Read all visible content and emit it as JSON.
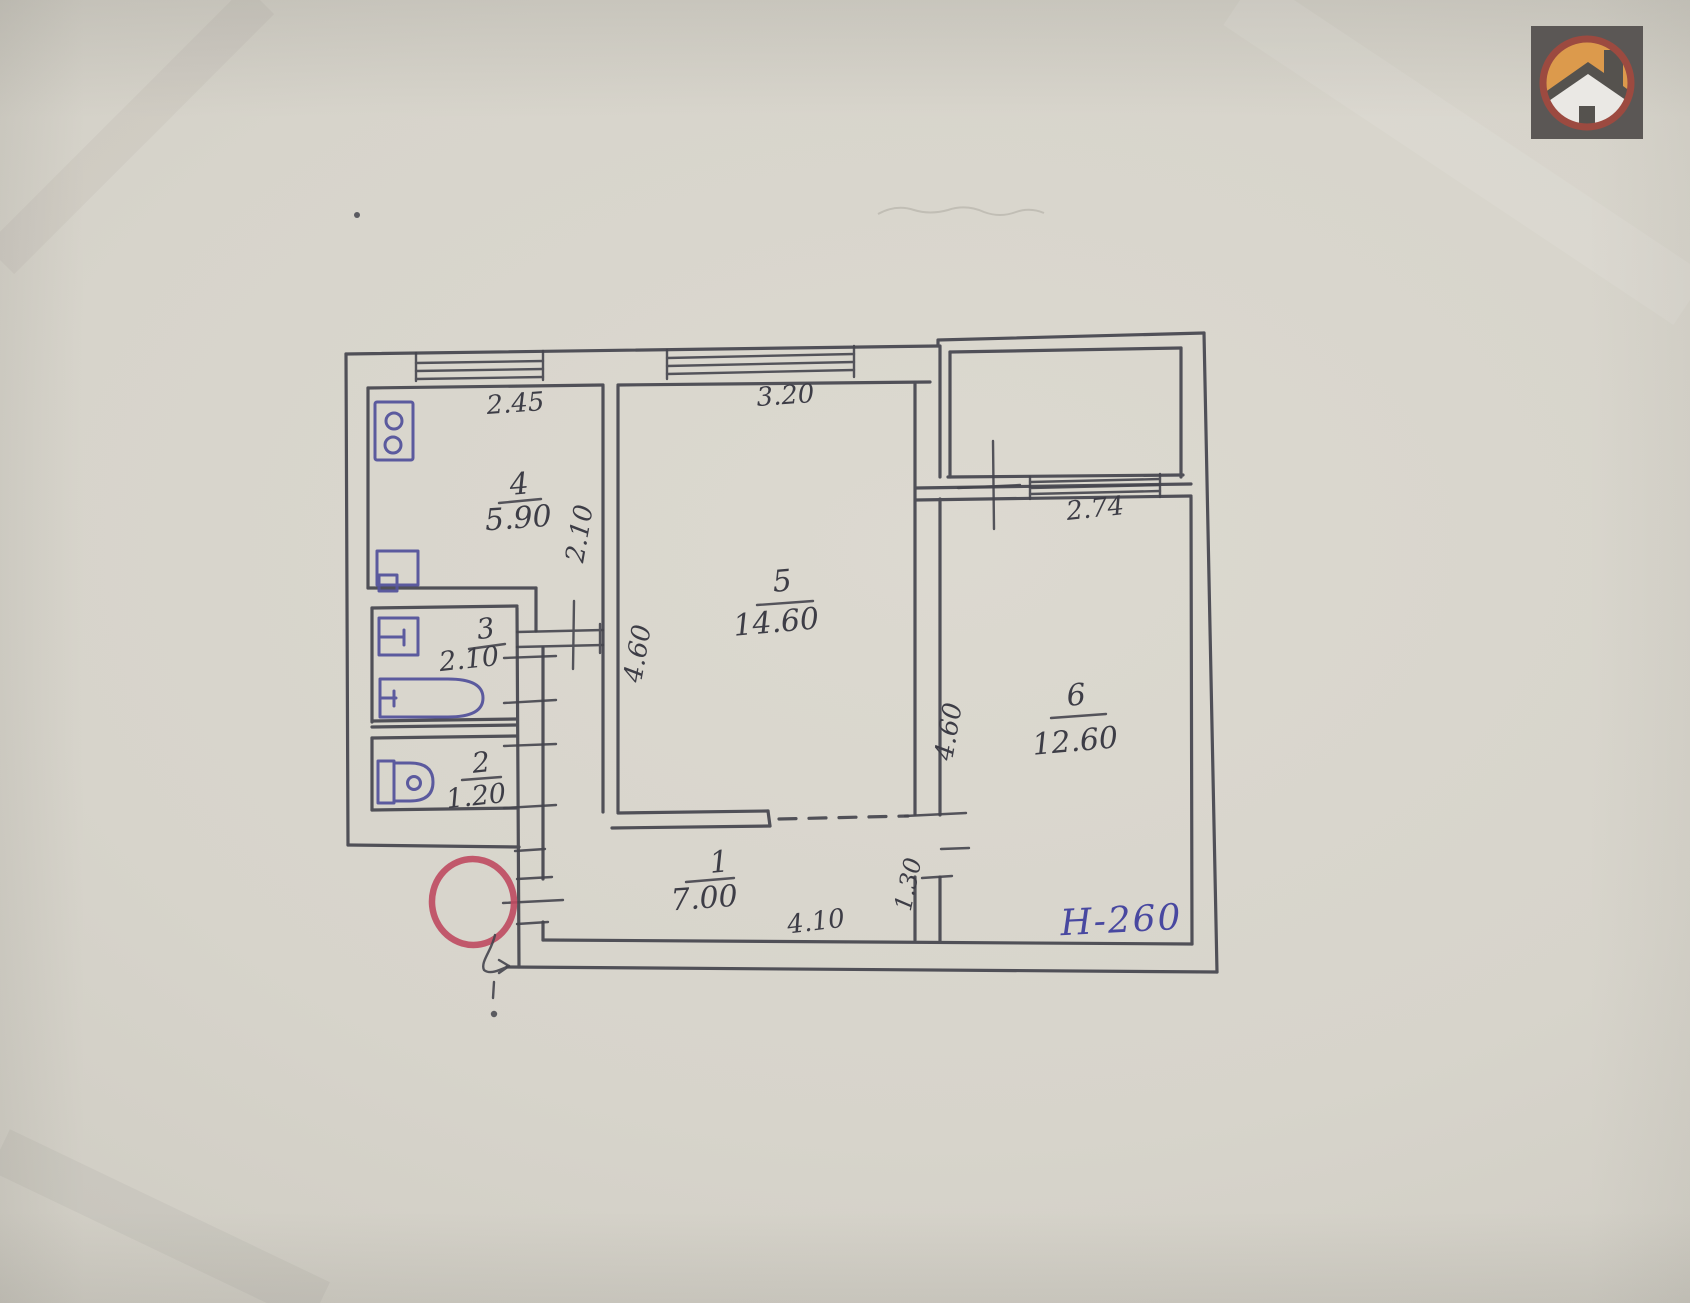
{
  "document": {
    "type": "scanned apartment floor plan",
    "paper_color": "#d7d4cb",
    "pencil_ink_color": "#45454e",
    "fixture_ink_color": "#55549c",
    "entrance_marker_color": "#bf4a60"
  },
  "logo": {
    "name": "house-logo",
    "square_color": "#5b5755",
    "ring_color": "#9c4a40",
    "sky_color": "#dc9a4c",
    "house_color": "#eae8e4",
    "roof_color": "#55524e"
  },
  "rooms": [
    {
      "number": "1",
      "area": "7.00"
    },
    {
      "number": "2",
      "area": "1.20"
    },
    {
      "number": "3",
      "area": "2.10"
    },
    {
      "number": "4",
      "area": "5.90"
    },
    {
      "number": "5",
      "area": "14.60"
    },
    {
      "number": "6",
      "area": "12.60"
    }
  ],
  "dimensions": {
    "kitchen_window": "2.45",
    "living_room_window": "3.20",
    "bedroom_window": "2.74",
    "hallway_length": "4.10",
    "corridor_depth": "2.10",
    "living_room_depth": "4.60",
    "bedroom_depth": "4.60",
    "hallway_nook": "1.30"
  },
  "annotations": {
    "ceiling_height": "H-260"
  },
  "icons": [
    "house-logo",
    "stove-icon",
    "kitchen-sink-icon",
    "washbasin-icon",
    "bathtub-icon",
    "toilet-icon",
    "entrance-circle-marker",
    "entrance-arrow"
  ]
}
